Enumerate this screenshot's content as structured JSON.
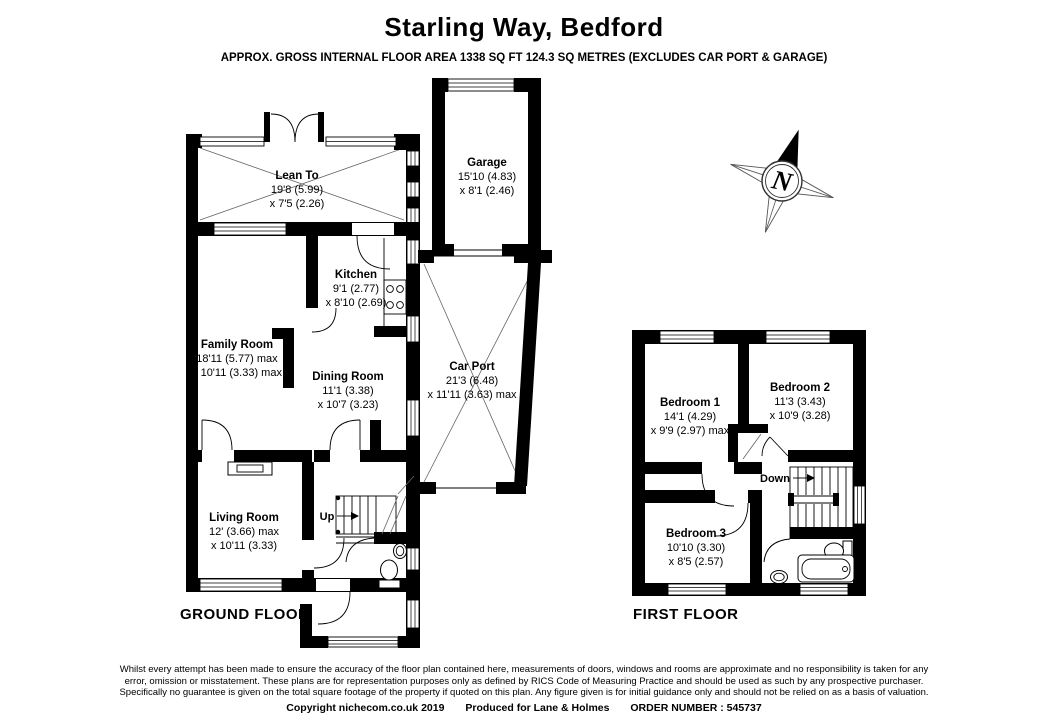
{
  "header": {
    "title": "Starling Way, Bedford",
    "subtitle": "APPROX. GROSS INTERNAL FLOOR AREA 1338 SQ FT 124.3 SQ METRES (EXCLUDES CAR PORT & GARAGE)"
  },
  "ground_floor": {
    "label": "GROUND FLOOR",
    "up_label": "Up",
    "rooms": {
      "lean_to": {
        "name": "Lean To",
        "dim1": "19'8 (5.99)",
        "dim2": "x 7'5 (2.26)"
      },
      "garage": {
        "name": "Garage",
        "dim1": "15'10 (4.83)",
        "dim2": "x 8'1 (2.46)"
      },
      "kitchen": {
        "name": "Kitchen",
        "dim1": "9'1 (2.77)",
        "dim2": "x 8'10 (2.69)"
      },
      "family_room": {
        "name": "Family Room",
        "dim1": "18'11 (5.77) max",
        "dim2": "x 10'11 (3.33) max"
      },
      "dining_room": {
        "name": "Dining Room",
        "dim1": "11'1 (3.38)",
        "dim2": "x 10'7 (3.23)"
      },
      "car_port": {
        "name": "Car Port",
        "dim1": "21'3 (6.48)",
        "dim2": "x 11'11 (3.63) max"
      },
      "living_room": {
        "name": "Living Room",
        "dim1": "12' (3.66) max",
        "dim2": "x 10'11 (3.33)"
      }
    }
  },
  "first_floor": {
    "label": "FIRST FLOOR",
    "down_label": "Down",
    "rooms": {
      "bedroom_1": {
        "name": "Bedroom 1",
        "dim1": "14'1 (4.29)",
        "dim2": "x 9'9 (2.97) max"
      },
      "bedroom_2": {
        "name": "Bedroom 2",
        "dim1": "11'3 (3.43)",
        "dim2": "x 10'9 (3.28)"
      },
      "bedroom_3": {
        "name": "Bedroom 3",
        "dim1": "10'10 (3.30)",
        "dim2": "x 8'5 (2.57)"
      }
    }
  },
  "compass": {
    "north_label": "N"
  },
  "footer": {
    "disclaimer_lines": [
      "Whilst every attempt has been made to ensure the accuracy of the floor plan contained here, measurements of doors, windows and rooms are approximate and no responsibility is taken for any",
      "error, omission or misstatement. These plans are for representation purposes only as defined by RICS Code of Measuring Practice and should be used as such by any prospective purchaser.",
      "Specifically no guarantee is given on the total square footage of the property if quoted on this plan. Any figure given is for initial guidance only and should not be relied on as a basis of valuation."
    ],
    "copyright": "Copyright nichecom.co.uk 2019",
    "produced_for": "Produced for Lane & Holmes",
    "order_number": "ORDER NUMBER : 545737"
  },
  "colors": {
    "wall": "#000000",
    "thin_line": "#666666",
    "background": "#ffffff"
  }
}
